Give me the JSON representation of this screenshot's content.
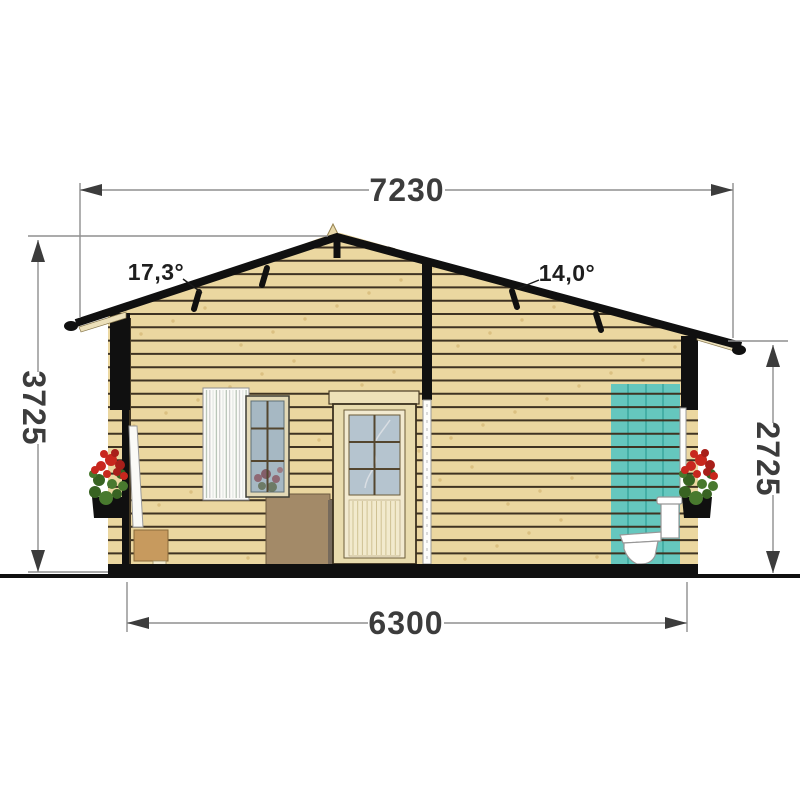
{
  "drawing": {
    "kind": "house cross-section elevation",
    "units_note": ""
  },
  "dimensions": {
    "roof_span_mm": "7230",
    "overall_height_mm": "3725",
    "wall_height_mm": "2725",
    "floor_span_mm": "6300"
  },
  "roof_angles": {
    "left": "17,3°",
    "right": "14,0°"
  },
  "colors": {
    "wall": "#ebd7a0",
    "wall_line": "#3f3322",
    "wall_speckle": "#c8a45a",
    "roof": "#101010",
    "teal": "#65c7be",
    "teal_line": "#3ba79e",
    "glass": "#a6b8c3",
    "door_glass": "#b5c4cf",
    "cream": "#f2ead0",
    "door_frame": "#e9dcae",
    "window_frame": "#e3d9b6",
    "muntin": "#54462f",
    "curtain": "#fbfbf8",
    "curtain_stripe_a": "#b9c6b9",
    "curtain_stripe_b": "#cfcfcf",
    "beadboard_line": "#cfc193",
    "furniture_small": "#c79a5e",
    "furniture_big": "#a38a68",
    "toilet": "#ffffff",
    "flower_red": "#c8271e",
    "flower_red_dark": "#a81f1a",
    "flower_green": "#48792e",
    "flower_green_dark": "#386322",
    "dim_line": "#8f8f8f",
    "dim_dark": "#3c3c3c",
    "underside": "#ece0ba"
  }
}
